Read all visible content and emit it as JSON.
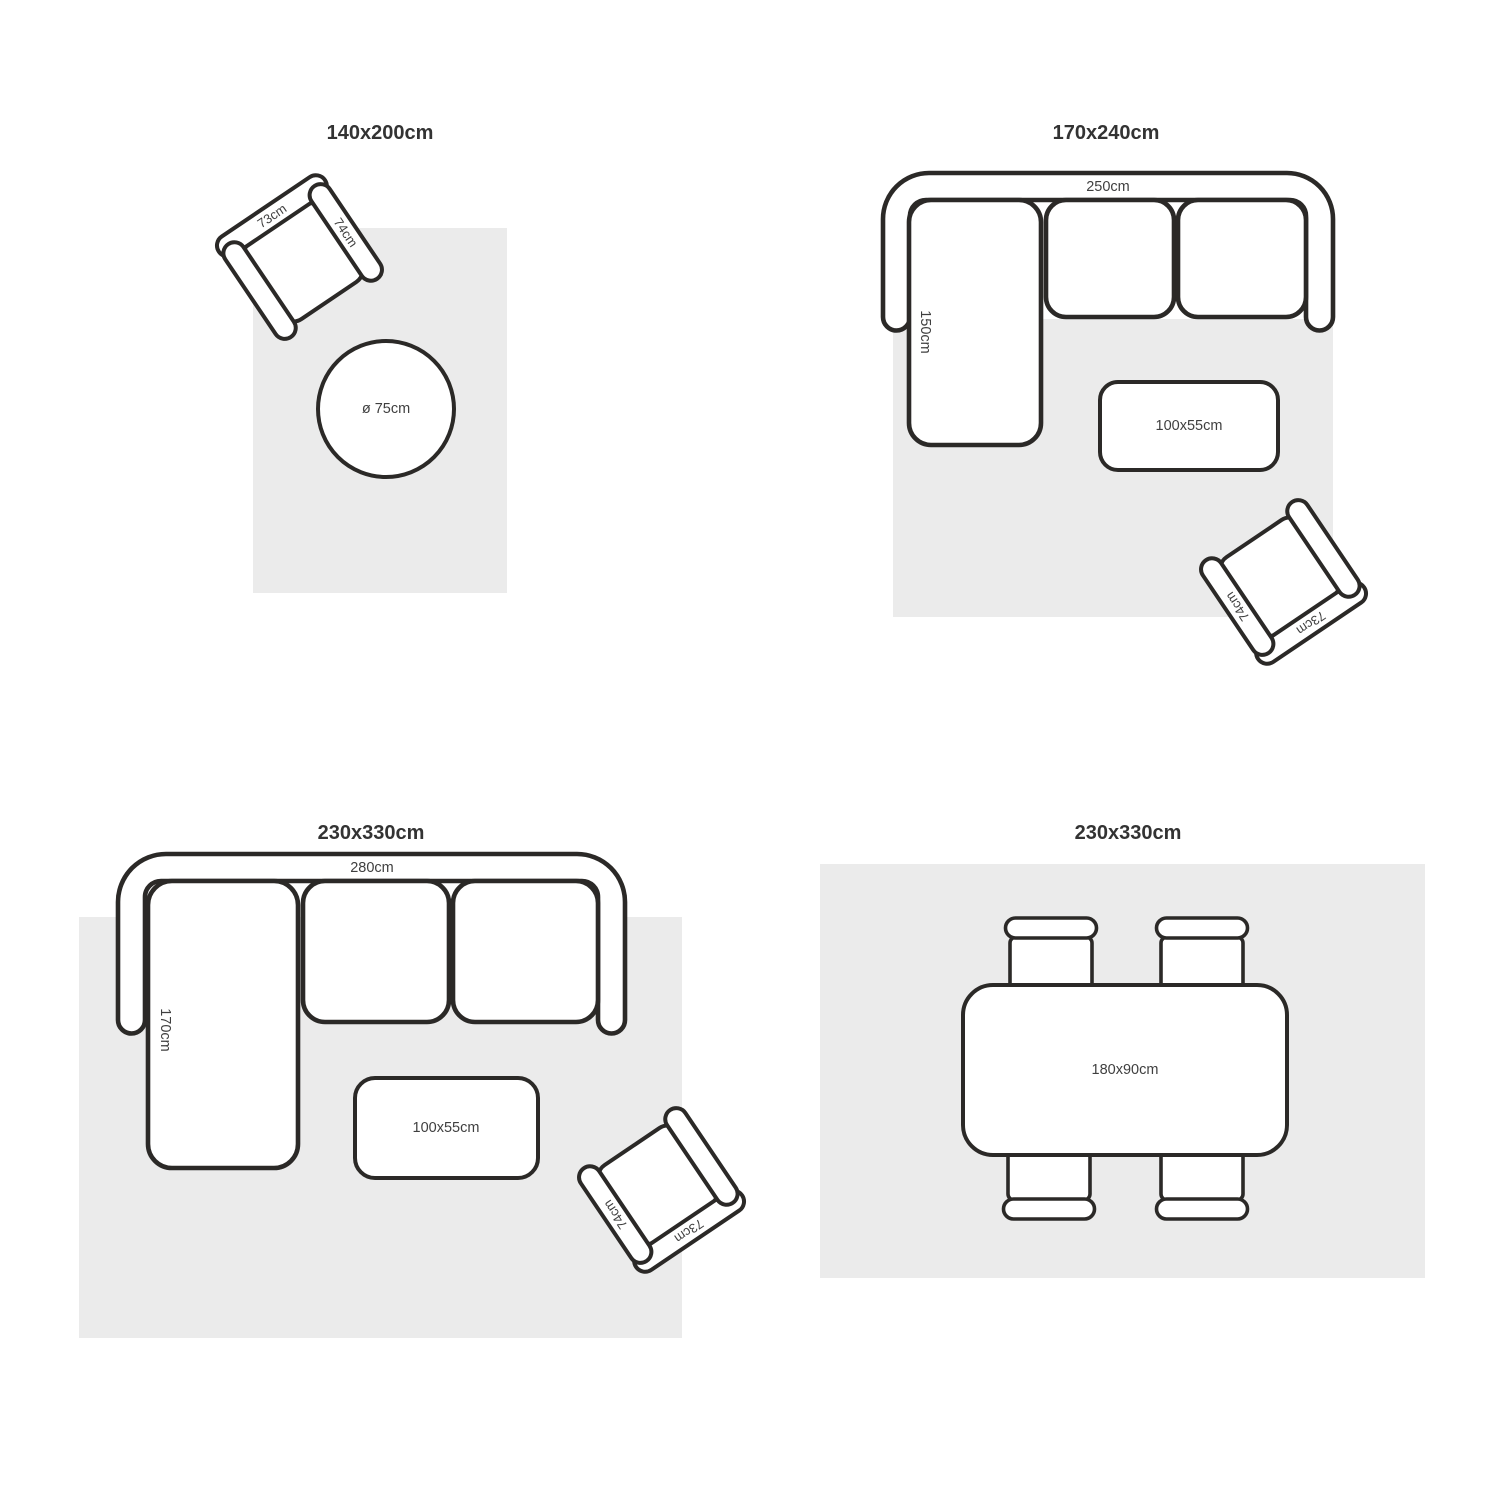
{
  "theme": {
    "ink": "#2b2927",
    "rug": "#ebebeb",
    "title": "#333333",
    "label": "#3f3f3f"
  },
  "panels": [
    {
      "title": "140x200cm",
      "armchair": {
        "back_label": "73cm",
        "arm_label": "74cm"
      },
      "round_table_label": "ø 75cm"
    },
    {
      "title": "170x240cm",
      "sofa": {
        "width_label": "250cm",
        "depth_label": "150cm"
      },
      "coffee_table_label": "100x55cm",
      "armchair": {
        "back_label": "73cm",
        "arm_label": "74cm"
      }
    },
    {
      "title": "230x330cm",
      "sofa": {
        "width_label": "280cm",
        "depth_label": "170cm"
      },
      "coffee_table_label": "100x55cm",
      "armchair": {
        "back_label": "73cm",
        "arm_label": "74cm"
      }
    },
    {
      "title": "230x330cm",
      "dining_table_label": "180x90cm"
    }
  ]
}
